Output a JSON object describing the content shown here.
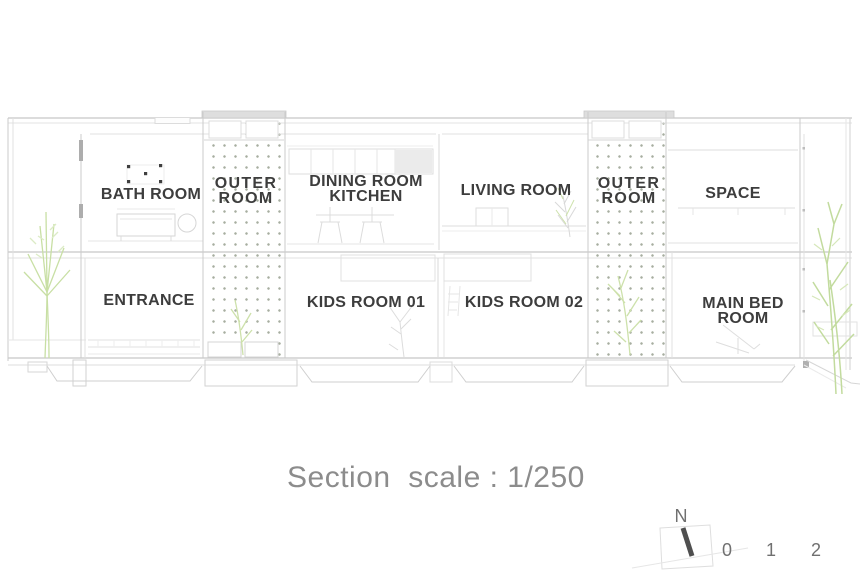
{
  "section": {
    "upper_rooms": [
      {
        "name": "bath-room",
        "label": "BATH ROOM"
      },
      {
        "name": "outer-room-1",
        "label": "OUTER\nROOM"
      },
      {
        "name": "dining-room-kitchen",
        "label": "DINING ROOM\nKITCHEN"
      },
      {
        "name": "living-room",
        "label": "LIVING ROOM"
      },
      {
        "name": "outer-room-2",
        "label": "OUTER\nROOM"
      },
      {
        "name": "space",
        "label": "SPACE"
      }
    ],
    "lower_rooms": [
      {
        "name": "entrance",
        "label": "ENTRANCE"
      },
      {
        "name": "kids-room-01",
        "label": "KIDS ROOM 01"
      },
      {
        "name": "kids-room-02",
        "label": "KIDS ROOM 02"
      },
      {
        "name": "main-bed-room",
        "label": "MAIN BED ROOM"
      }
    ],
    "caption": "Section  scale : 1/250",
    "compass": {
      "north": "N"
    },
    "scale_bar": {
      "ticks": [
        "0",
        "1",
        "2"
      ]
    }
  },
  "colors": {
    "label-text": "#3d3d3d",
    "caption-text": "#8c8c8c",
    "tick-text": "#707070",
    "screen-dot": "#98a08f",
    "plant-green": "#c6dda2",
    "needle": "#4f4f4f"
  }
}
